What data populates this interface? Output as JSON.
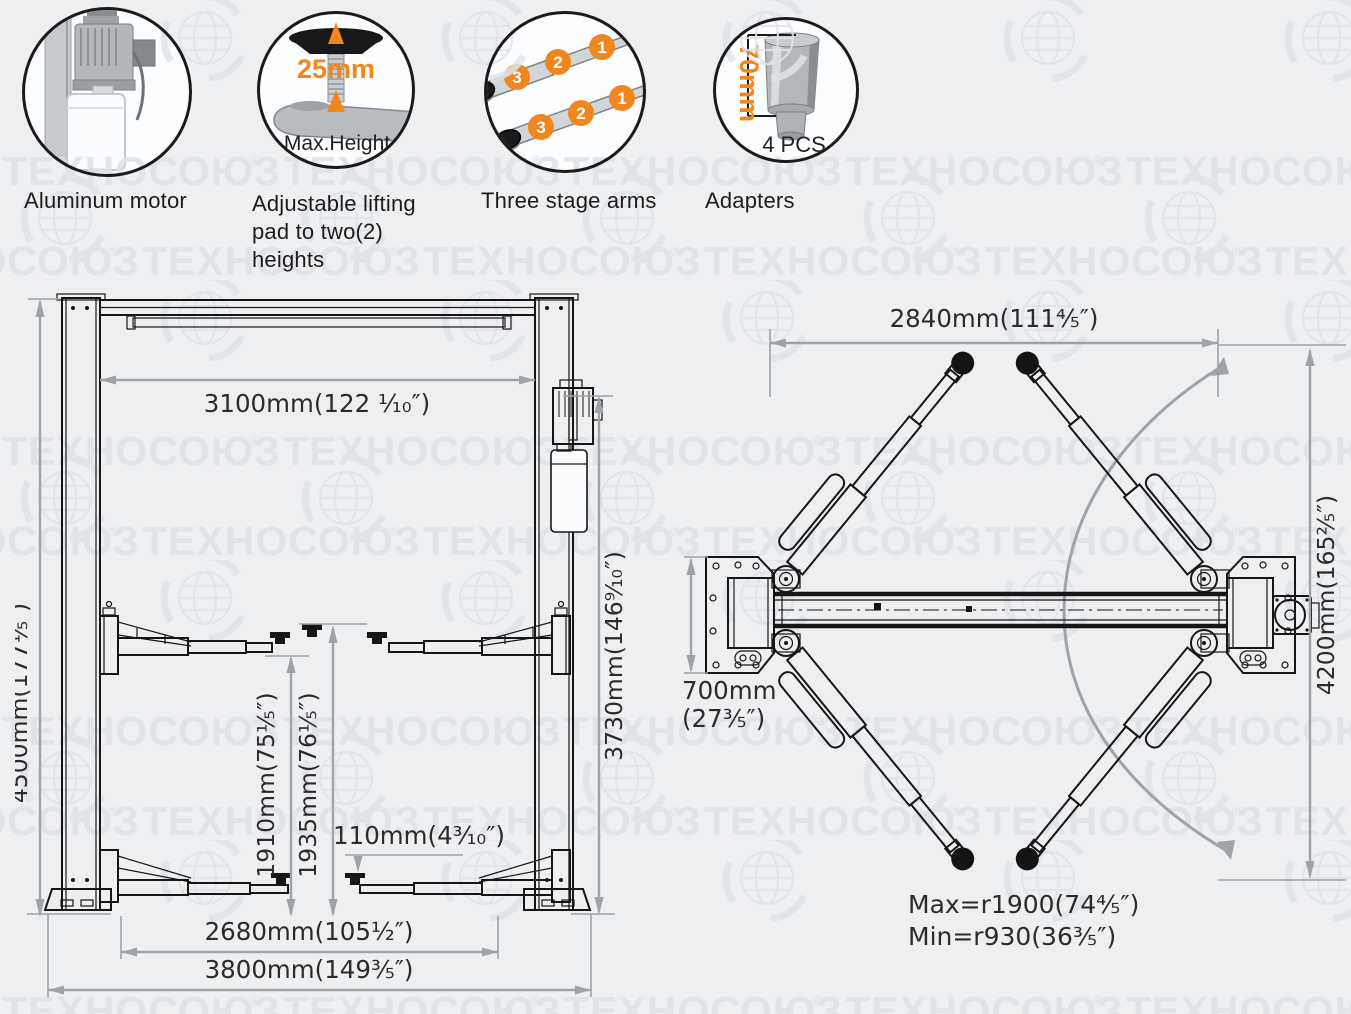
{
  "colors": {
    "background": "#edeff1",
    "line": "#161616",
    "dimension_line": "#9fa3a6",
    "accent_orange": "#f0861c",
    "watermark": "#dee2e6",
    "text": "#1c1c1c"
  },
  "watermark": {
    "brand": "ТЕХНОСОЮЗ",
    "registered": "®"
  },
  "features": [
    {
      "caption": "Aluminum motor"
    },
    {
      "caption": "Adjustable lifting pad to two(2) heights",
      "highlight": "25mm",
      "label": "Max.Height"
    },
    {
      "caption": "Three stage arms",
      "stages": [
        "1",
        "2",
        "3"
      ]
    },
    {
      "caption": "Adapters",
      "highlight": "70mm",
      "label": "4 PCS"
    }
  ],
  "front_view": {
    "labels": {
      "overall_height": "4500mm(177⅕″)",
      "inner_width": "3100mm(122 ¹⁄₁₀″)",
      "column_height": "3730mm(146⁹⁄₁₀″)",
      "lift_height_low": "1910mm(75⅕″)",
      "lift_height_high": "1935mm(76⅕″)",
      "pad_min_height": "110mm(4³⁄₁₀″)",
      "base_inner_width": "2680mm(105½″)",
      "overall_width": "3800mm(149⅗″)"
    }
  },
  "top_view": {
    "labels": {
      "drive_through_width": "2840mm(111⅘″)",
      "overall_length": "4200mm(165⅖″)",
      "base_plate_depth_line1": "700mm",
      "base_plate_depth_line2": "(27⅗″)",
      "arm_radius_max": "Max=r1900(74⅘″)",
      "arm_radius_min": "Min=r930(36⅗″)"
    }
  }
}
